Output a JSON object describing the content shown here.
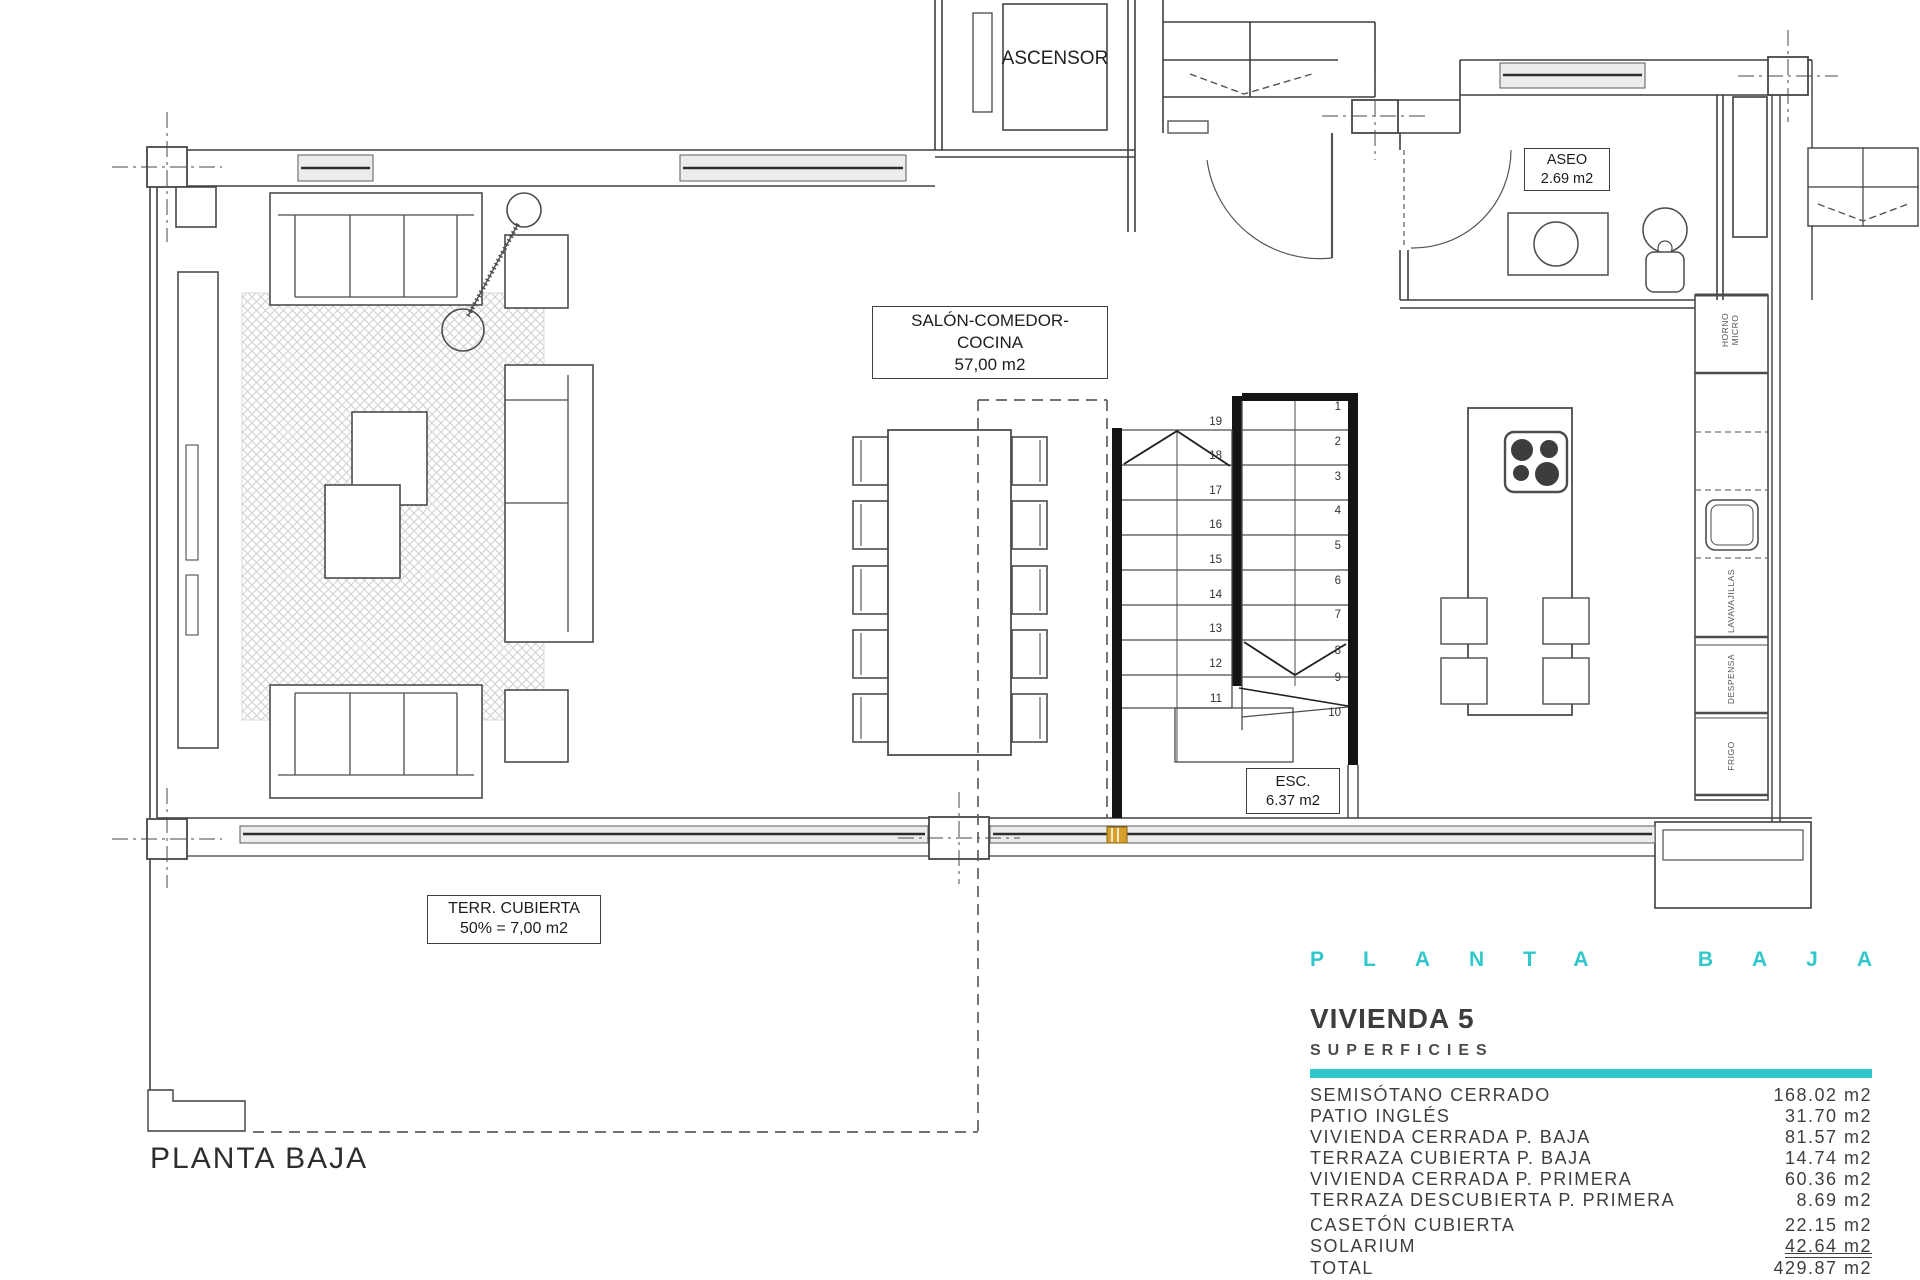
{
  "colors": {
    "accent_cyan": "#31c7cb",
    "line_gray": "#4c4c4c",
    "wall_black": "#141414",
    "marker_orange": "#d6a02b"
  },
  "labels": {
    "ascensor": "ASCENSOR",
    "aseo_name": "ASEO",
    "aseo_area": "2.69 m2",
    "salon_name": "SALÓN-COMEDOR-COCINA",
    "salon_area": "57,00 m2",
    "esc_name": "ESC.",
    "esc_area": "6.37 m2",
    "terraza_name": "TERR. CUBIERTA",
    "terraza_area": "50% = 7,00 m2",
    "floor_caption": "PLANTA BAJA"
  },
  "kitchen": {
    "unit_horno": "HORNO MICRO",
    "unit_lavavajillas": "LAVAVAJILLAS",
    "unit_despensa": "DESPENSA",
    "unit_frigo": "FRIGO"
  },
  "stairs": {
    "left": [
      "19",
      "18",
      "17",
      "16",
      "15",
      "14",
      "13",
      "12",
      "11"
    ],
    "right": [
      "1",
      "2",
      "3",
      "4",
      "5",
      "6",
      "7",
      "8",
      "9",
      "10"
    ]
  },
  "title_block": {
    "floor_word_1": "PLANTA",
    "floor_word_2": "BAJA",
    "unit_title": "VIVIENDA 5",
    "section_title": "SUPERFICIES",
    "rows": [
      {
        "label": "SEMISÓTANO CERRADO",
        "value": "168.02 m2"
      },
      {
        "label": "PATIO INGLÉS",
        "value": "31.70 m2"
      },
      {
        "label": "VIVIENDA CERRADA P. BAJA",
        "value": "81.57 m2"
      },
      {
        "label": "TERRAZA CUBIERTA P. BAJA",
        "value": "14.74 m2"
      },
      {
        "label": "VIVIENDA CERRADA P. PRIMERA",
        "value": "60.36 m2"
      },
      {
        "label": "TERRAZA DESCUBIERTA P. PRIMERA",
        "value": "8.69 m2"
      },
      {
        "label": "CASETÓN CUBIERTA",
        "value": "22.15 m2"
      },
      {
        "label": "SOLARIUM",
        "value": "42.64 m2"
      },
      {
        "label": "TOTAL",
        "value": "429.87 m2"
      }
    ]
  }
}
